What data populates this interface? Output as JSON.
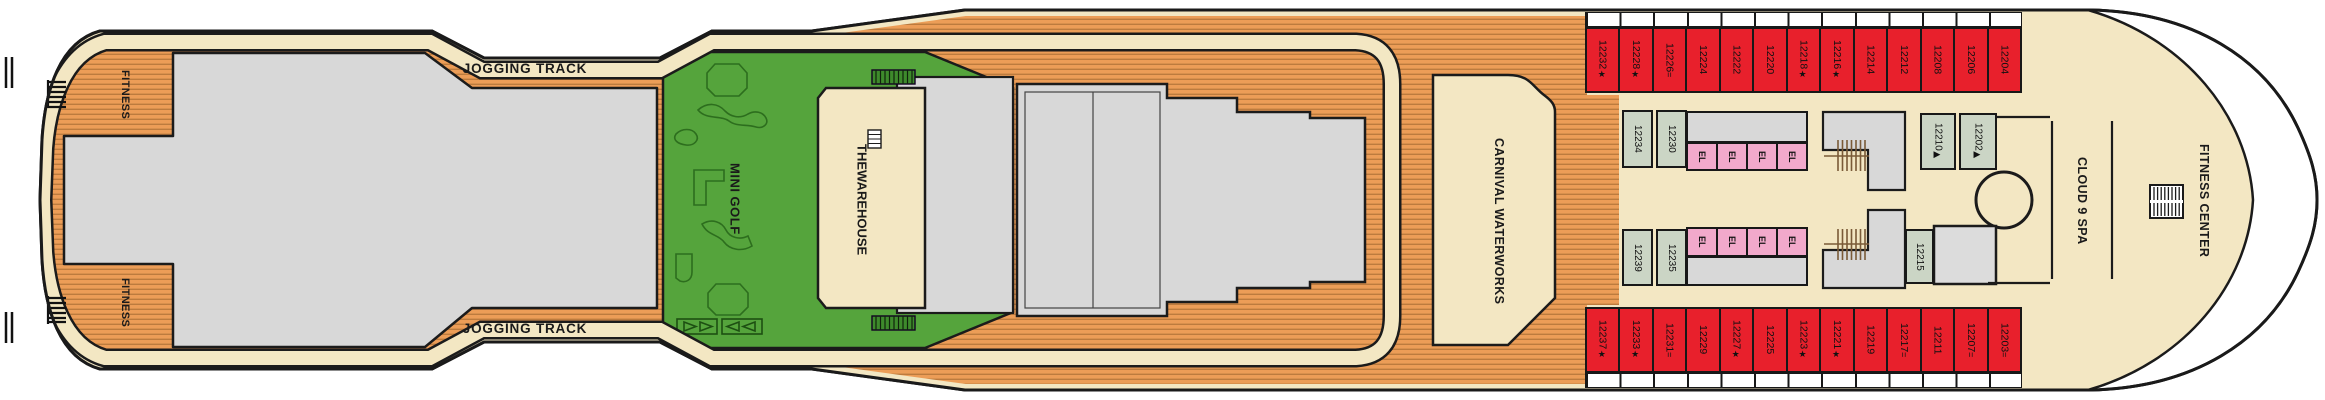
{
  "deck": {
    "labels": {
      "fitness_top": "FITNESS",
      "fitness_bottom": "FITNESS",
      "jogging_track_top": "JOGGING TRACK",
      "jogging_track_bottom": "JOGGING TRACK",
      "mini_golf": "MINI GOLF",
      "warehouse_line1": "THE",
      "warehouse_line2": "WAREHOUSE",
      "carnival_waterworks": "CARNIVAL WATERWORKS",
      "cloud_9_spa": "CLOUD 9 SPA",
      "fitness_center": "FITNESS CENTER"
    },
    "cabins": {
      "top_row": [
        {
          "n": "12232",
          "s": "★"
        },
        {
          "n": "12228",
          "s": "★"
        },
        {
          "n": "12226",
          "s": "="
        },
        {
          "n": "12224",
          "s": ""
        },
        {
          "n": "12222",
          "s": ""
        },
        {
          "n": "12220",
          "s": ""
        },
        {
          "n": "12218",
          "s": "★"
        },
        {
          "n": "12216",
          "s": "★"
        },
        {
          "n": "12214",
          "s": ""
        },
        {
          "n": "12212",
          "s": ""
        },
        {
          "n": "12208",
          "s": ""
        },
        {
          "n": "12206",
          "s": ""
        },
        {
          "n": "12204",
          "s": ""
        }
      ],
      "bottom_row": [
        {
          "n": "12237",
          "s": "★"
        },
        {
          "n": "12233",
          "s": "★"
        },
        {
          "n": "12231",
          "s": "="
        },
        {
          "n": "12229",
          "s": ""
        },
        {
          "n": "12227",
          "s": "★"
        },
        {
          "n": "12225",
          "s": ""
        },
        {
          "n": "12223",
          "s": "★"
        },
        {
          "n": "12221",
          "s": "★"
        },
        {
          "n": "12219",
          "s": ""
        },
        {
          "n": "12217",
          "s": "="
        },
        {
          "n": "12211",
          "s": ""
        },
        {
          "n": "12207",
          "s": "="
        },
        {
          "n": "12203",
          "s": "="
        }
      ],
      "interior_top": [
        {
          "n": "12234",
          "s": ""
        },
        {
          "n": "12230",
          "s": ""
        },
        {
          "n": "12210",
          "s": "▶"
        },
        {
          "n": "12202",
          "s": "▶"
        }
      ],
      "interior_bottom": [
        {
          "n": "12239",
          "s": ""
        },
        {
          "n": "12235",
          "s": ""
        },
        {
          "n": "12215",
          "s": ""
        }
      ],
      "elevators_top": [
        "EL",
        "EL",
        "EL",
        "EL"
      ],
      "elevators_bottom": [
        "EL",
        "EL",
        "EL",
        "EL"
      ]
    },
    "colors": {
      "wood-base": "#EC9D57",
      "wood-stripe": "#BC7B3E",
      "cream": "#F3E7C3",
      "deck-gray": "#D8D8D8",
      "golf-green": "#55A43C",
      "cabin-red": "#E8202C",
      "cabin-sage": "#CBD5C5",
      "elevator-pink": "#F2A9CB",
      "outline": "#1A1A1A"
    }
  }
}
